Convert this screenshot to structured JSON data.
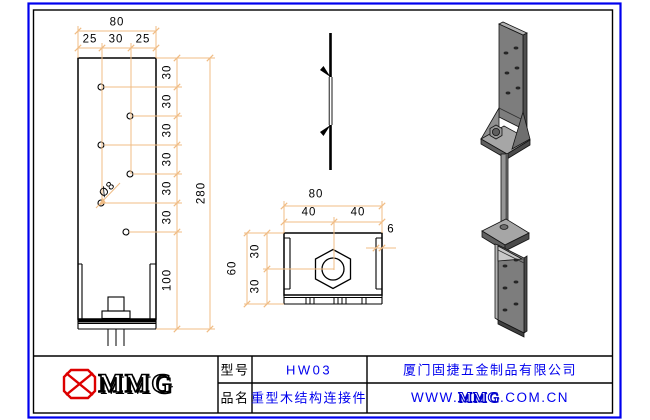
{
  "sheet": {
    "type": "engineering-drawing"
  },
  "colors": {
    "border_blue": "#0000ee",
    "line_black": "#000000",
    "dimension_orange": "#f0bc84",
    "text_blue": "#0000ee",
    "logo_red": "#dd0000",
    "metal_gray": "#7d7d7d"
  },
  "views": {
    "front": {
      "dim_total_width": "80",
      "dim_width_segs": [
        "25",
        "30",
        "25"
      ],
      "dim_rows": [
        "30",
        "30",
        "30",
        "30",
        "30",
        "30"
      ],
      "dim_bottom_row": "100",
      "dim_total_height": "280",
      "hole_diameter": "Ø8"
    },
    "plan": {
      "dim_total_width": "80",
      "dim_half": [
        "40",
        "40"
      ],
      "dim_flange_thickness": "6",
      "dim_total_depth": "60",
      "dim_depth_segs": [
        "30",
        "30"
      ]
    }
  },
  "title_block": {
    "logo_brand": "MMG",
    "model_label": "型号",
    "model_value": "HW03",
    "product_label": "品名",
    "product_value": "重型木结构连接件",
    "company_name": "厦门固捷五金制品有限公司",
    "website": {
      "prefix": "WWW.",
      "brand": "MMG",
      "suffix": ".COM.CN"
    }
  }
}
